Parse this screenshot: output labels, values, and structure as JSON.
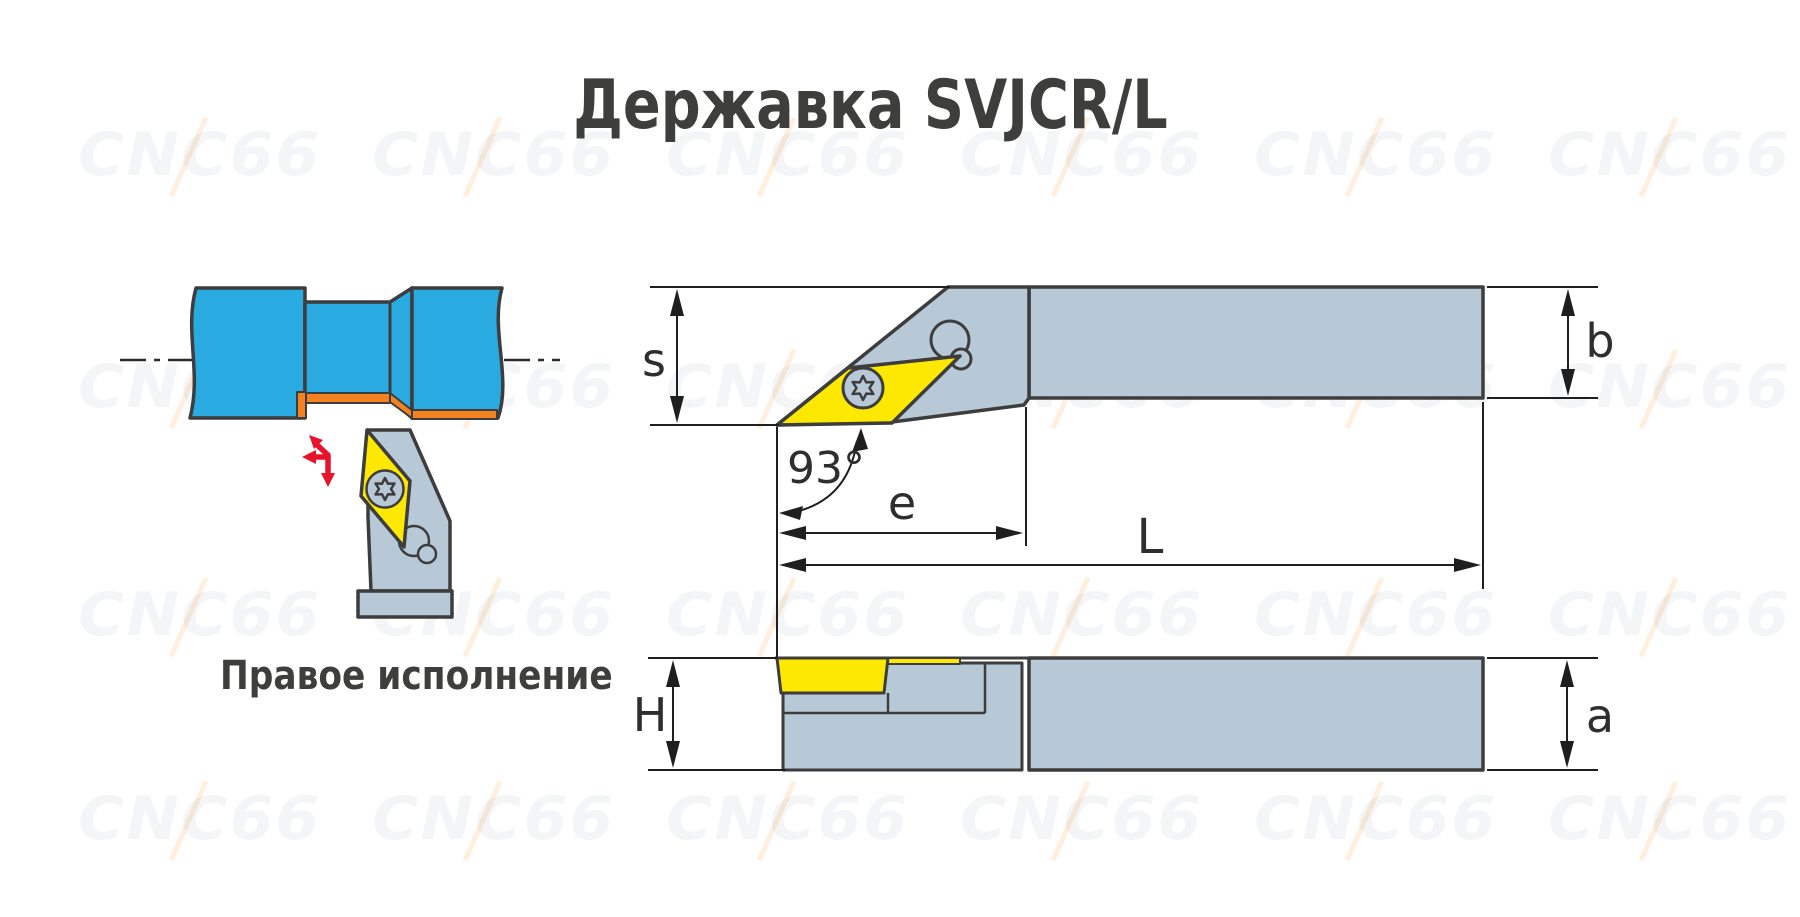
{
  "title": "Державка SVJCR/L",
  "caption": "Правое исполнение",
  "watermark": {
    "text": "CNC66"
  },
  "drawing": {
    "dimensions": {
      "s": "s",
      "b": "b",
      "e": "e",
      "L": "L",
      "H": "H",
      "a": "a",
      "lead_angle": "93°"
    }
  },
  "colors": {
    "blue": "#29abe2",
    "orange": "#f58220",
    "yellow": "#fde802",
    "gray": "#b7c9d6",
    "outline": "#3d3d3d",
    "dim": "#1f1f1f",
    "red": "#e8132b",
    "text": "#3e3e3d"
  }
}
